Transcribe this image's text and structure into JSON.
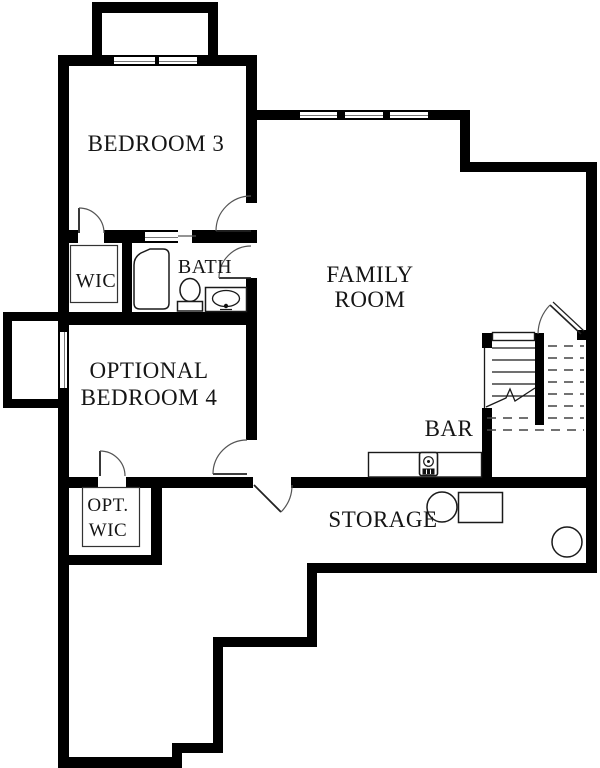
{
  "floorplan": {
    "rooms": {
      "bedroom3": {
        "label": "BEDROOM 3"
      },
      "wic": {
        "label": "WIC"
      },
      "bath": {
        "label": "BATH"
      },
      "family_room": {
        "line1": "FAMILY",
        "line2": "ROOM"
      },
      "optional_bedroom4": {
        "line1": "OPTIONAL",
        "line2": "BEDROOM 4"
      },
      "opt_wic": {
        "line1": "OPT.",
        "line2": "WIC"
      },
      "bar": {
        "label": "BAR"
      },
      "storage": {
        "label": "STORAGE"
      }
    },
    "colors": {
      "walls": "#000000",
      "background": "#ffffff",
      "thin_lines": "#333333",
      "door_arcs": "#555555"
    },
    "fixtures": [
      "bathtub",
      "toilet",
      "vanity-sink",
      "bar-counter",
      "bar-sink",
      "staircase",
      "stair-break-line",
      "closet-shelving",
      "round-tank-fixture",
      "rect-equipment-fixture",
      "window",
      "door-swing",
      "window-well"
    ]
  }
}
